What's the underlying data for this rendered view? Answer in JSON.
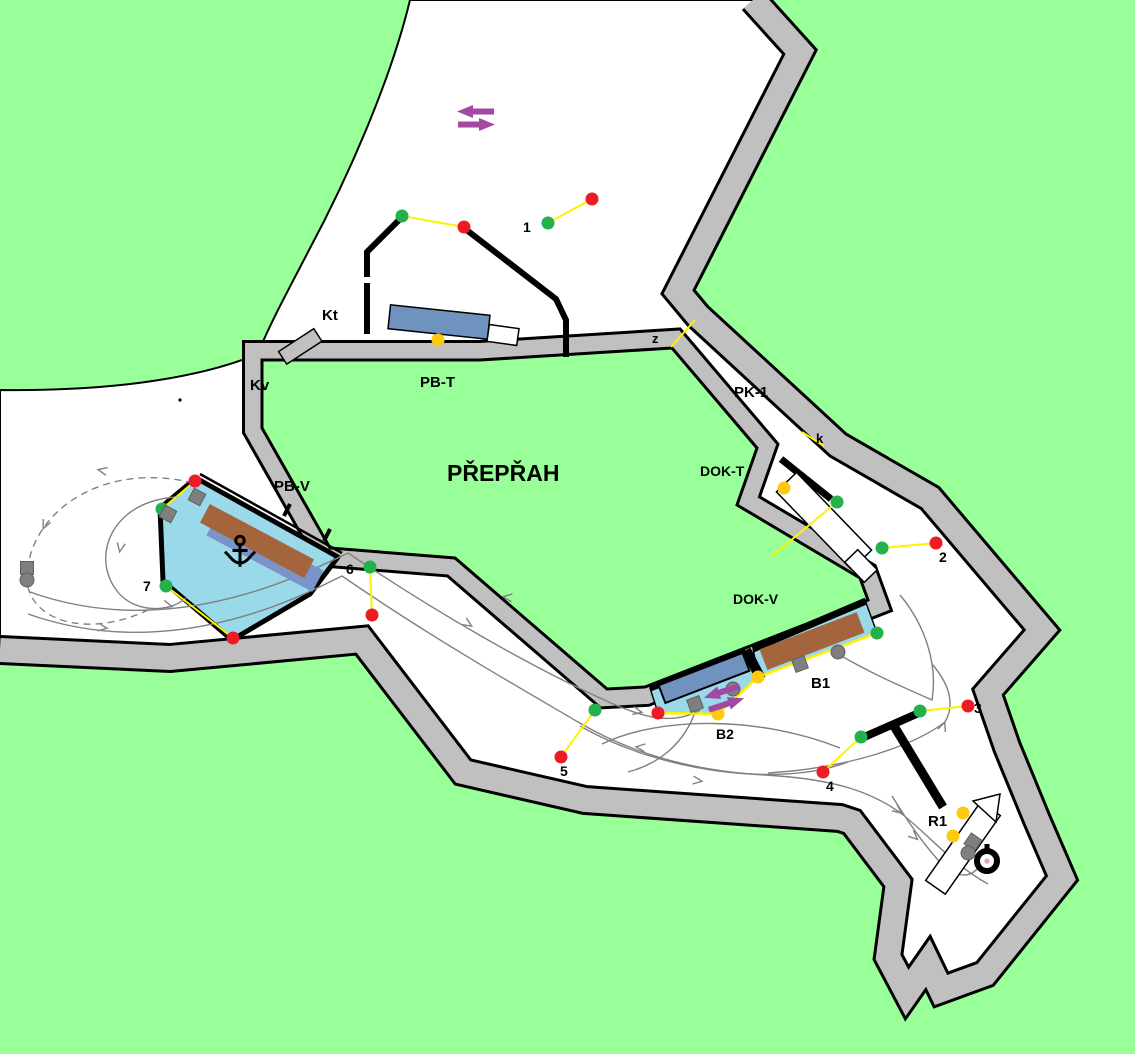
{
  "title": {
    "text": "PŘEPŘAH",
    "x": 447,
    "y": 481,
    "size": 23
  },
  "colors": {
    "land": "#99FF99",
    "water": "#FFFFFF",
    "embankment": "#C0C0C0",
    "outline": "#000000",
    "basin": "#99D9EA",
    "basin_shadow": "#7B93C7",
    "barge_blue": "#7092BE",
    "barge_brown": "#A5653C",
    "dot_red": "#ED1C24",
    "dot_green": "#22B14C",
    "dot_gold": "#FFC90E",
    "line_yellow": "#FFF200",
    "arrow_purple": "#A349A4",
    "marker_gray": "#7F7F7F",
    "route_gray": "#808080"
  },
  "labels": [
    {
      "id": "kt",
      "text": "Kt",
      "x": 322,
      "y": 320,
      "size": 15
    },
    {
      "id": "kv",
      "text": "Kv",
      "x": 250,
      "y": 390,
      "size": 15
    },
    {
      "id": "pb-t",
      "text": "PB-T",
      "x": 420,
      "y": 387,
      "size": 15
    },
    {
      "id": "pb-v",
      "text": "PB-V",
      "x": 274,
      "y": 491,
      "size": 15
    },
    {
      "id": "pk-1",
      "text": "PK-1",
      "x": 734,
      "y": 397,
      "size": 15
    },
    {
      "id": "dok-t",
      "text": "DOK-T",
      "x": 700,
      "y": 476,
      "size": 14
    },
    {
      "id": "dok-v",
      "text": "DOK-V",
      "x": 733,
      "y": 604,
      "size": 14
    },
    {
      "id": "b1",
      "text": "B1",
      "x": 811,
      "y": 688,
      "size": 15
    },
    {
      "id": "b2",
      "text": "B2",
      "x": 716,
      "y": 739,
      "size": 14
    },
    {
      "id": "r1",
      "text": "R1",
      "x": 928,
      "y": 826,
      "size": 15
    },
    {
      "id": "n1",
      "text": "1",
      "x": 523,
      "y": 232,
      "size": 14
    },
    {
      "id": "n2",
      "text": "2",
      "x": 939,
      "y": 562,
      "size": 14
    },
    {
      "id": "n3",
      "text": "3",
      "x": 974,
      "y": 713,
      "size": 14
    },
    {
      "id": "n4",
      "text": "4",
      "x": 826,
      "y": 791,
      "size": 14
    },
    {
      "id": "n5",
      "text": "5",
      "x": 560,
      "y": 776,
      "size": 14
    },
    {
      "id": "n6",
      "text": "6",
      "x": 346,
      "y": 574,
      "size": 14
    },
    {
      "id": "n7",
      "text": "7",
      "x": 143,
      "y": 591,
      "size": 14
    },
    {
      "id": "z",
      "text": "z",
      "x": 652,
      "y": 343,
      "size": 13
    },
    {
      "id": "k",
      "text": "k",
      "x": 816,
      "y": 443,
      "size": 13
    }
  ],
  "nav_points": [
    {
      "c": "green",
      "x": 402,
      "y": 216
    },
    {
      "c": "green",
      "x": 548,
      "y": 223
    },
    {
      "c": "green",
      "x": 162,
      "y": 509
    },
    {
      "c": "green",
      "x": 166,
      "y": 586
    },
    {
      "c": "green",
      "x": 370,
      "y": 567
    },
    {
      "c": "green",
      "x": 595,
      "y": 710
    },
    {
      "c": "green",
      "x": 837,
      "y": 502
    },
    {
      "c": "green",
      "x": 882,
      "y": 548
    },
    {
      "c": "green",
      "x": 877,
      "y": 633
    },
    {
      "c": "green",
      "x": 920,
      "y": 711
    },
    {
      "c": "green",
      "x": 861,
      "y": 737
    },
    {
      "c": "red",
      "x": 464,
      "y": 227
    },
    {
      "c": "red",
      "x": 592,
      "y": 199
    },
    {
      "c": "red",
      "x": 195,
      "y": 481
    },
    {
      "c": "red",
      "x": 233,
      "y": 638
    },
    {
      "c": "red",
      "x": 372,
      "y": 615
    },
    {
      "c": "red",
      "x": 561,
      "y": 757
    },
    {
      "c": "red",
      "x": 658,
      "y": 713
    },
    {
      "c": "red",
      "x": 936,
      "y": 543
    },
    {
      "c": "red",
      "x": 968,
      "y": 706
    },
    {
      "c": "red",
      "x": 823,
      "y": 772
    },
    {
      "c": "gold",
      "x": 438,
      "y": 340
    },
    {
      "c": "gold",
      "x": 784,
      "y": 488
    },
    {
      "c": "gold",
      "x": 758,
      "y": 677
    },
    {
      "c": "gold",
      "x": 718,
      "y": 714
    },
    {
      "c": "gold",
      "x": 963,
      "y": 813
    },
    {
      "c": "gold",
      "x": 953,
      "y": 836
    }
  ],
  "yellow_segments": [
    [
      402,
      216,
      464,
      227
    ],
    [
      548,
      223,
      592,
      199
    ],
    [
      162,
      509,
      195,
      481
    ],
    [
      166,
      586,
      233,
      638
    ],
    [
      370,
      567,
      372,
      615
    ],
    [
      595,
      710,
      561,
      757
    ],
    [
      882,
      548,
      936,
      543
    ],
    [
      837,
      502,
      772,
      556
    ],
    [
      920,
      711,
      968,
      706
    ],
    [
      861,
      737,
      823,
      772
    ],
    [
      877,
      633,
      758,
      677
    ],
    [
      758,
      677,
      718,
      714
    ],
    [
      718,
      714,
      658,
      713
    ],
    [
      671,
      347,
      695,
      320
    ],
    [
      802,
      432,
      824,
      446
    ]
  ],
  "gray_markers": {
    "squares": [
      {
        "x": 197,
        "y": 497,
        "rot": 28
      },
      {
        "x": 168,
        "y": 514,
        "rot": 28
      },
      {
        "x": 27,
        "y": 568,
        "rot": 0
      },
      {
        "x": 695,
        "y": 704,
        "rot": -20
      },
      {
        "x": 800,
        "y": 664,
        "rot": -20
      },
      {
        "x": 973,
        "y": 842,
        "rot": -55
      }
    ],
    "circles": [
      {
        "x": 27,
        "y": 580
      },
      {
        "x": 733,
        "y": 689
      },
      {
        "x": 838,
        "y": 652
      },
      {
        "x": 968,
        "y": 853
      }
    ]
  },
  "walls": [
    {
      "name": "training-wall-left-upper",
      "pts": [
        [
          402,
          217
        ],
        [
          367,
          252
        ],
        [
          367,
          277
        ]
      ],
      "w": 6
    },
    {
      "name": "training-wall-left-lower",
      "pts": [
        [
          367,
          283
        ],
        [
          367,
          334
        ]
      ],
      "w": 6
    },
    {
      "name": "training-wall-right",
      "pts": [
        [
          464,
          228
        ],
        [
          556,
          299
        ],
        [
          566,
          320
        ],
        [
          566,
          357
        ]
      ],
      "w": 6
    },
    {
      "name": "dokt-quay-wall",
      "pts": [
        [
          781,
          459
        ],
        [
          831,
          499
        ]
      ],
      "w": 7
    },
    {
      "name": "r1-t-wall-horizontal",
      "pts": [
        [
          862,
          738
        ],
        [
          921,
          712
        ]
      ],
      "w": 8
    },
    {
      "name": "r1-t-wall-vertical",
      "pts": [
        [
          894,
          726
        ],
        [
          943,
          807
        ]
      ],
      "w": 9
    },
    {
      "name": "b2-quay-wall",
      "pts": [
        [
          650,
          688
        ],
        [
          746,
          652
        ]
      ],
      "w": 7
    },
    {
      "name": "b1-quay-wall",
      "pts": [
        [
          753,
          649
        ],
        [
          866,
          601
        ]
      ],
      "w": 7
    },
    {
      "name": "b1-b2-separator-wall",
      "pts": [
        [
          746,
          650
        ],
        [
          761,
          679
        ]
      ],
      "w": 10
    },
    {
      "name": "pbv-dolphin-1",
      "pts": [
        [
          290,
          504
        ],
        [
          284,
          516
        ]
      ],
      "w": 4
    },
    {
      "name": "pbv-dolphin-2",
      "pts": [
        [
          330,
          529
        ],
        [
          324,
          541
        ]
      ],
      "w": 4
    }
  ],
  "vessels": [
    {
      "name": "pbv-barge-shadow",
      "shape": "rect",
      "cx": 265,
      "cy": 553,
      "w": 120,
      "h": 24,
      "rot": 28,
      "fill": "basin_shadow",
      "stroke": "none",
      "sw": 0
    },
    {
      "name": "pbv-barge",
      "shape": "rect",
      "cx": 257,
      "cy": 541,
      "w": 118,
      "h": 21,
      "rot": 28,
      "fill": "barge_brown",
      "stroke": "none",
      "sw": 0
    },
    {
      "name": "pbt-barge",
      "shape": "rect",
      "cx": 439,
      "cy": 322,
      "w": 100,
      "h": 24,
      "rot": 6,
      "fill": "barge_blue",
      "stroke": "outline",
      "sw": 1.5
    },
    {
      "name": "pbt-pusher",
      "shape": "rect",
      "cx": 503,
      "cy": 335,
      "w": 30,
      "h": 17,
      "rot": 8,
      "fill": "water",
      "stroke": "outline",
      "sw": 1.5
    },
    {
      "name": "dokt-vessel",
      "shape": "rect",
      "cx": 824,
      "cy": 521,
      "w": 108,
      "h": 28,
      "rot": 46,
      "fill": "water",
      "stroke": "outline",
      "sw": 1.5
    },
    {
      "name": "dokt-pusher",
      "shape": "rect",
      "cx": 861,
      "cy": 566,
      "w": 28,
      "h": 18,
      "rot": 46,
      "fill": "water",
      "stroke": "outline",
      "sw": 1.5
    },
    {
      "name": "b2-barge",
      "shape": "rect",
      "cx": 704,
      "cy": 678,
      "w": 90,
      "h": 19,
      "rot": -21,
      "fill": "barge_blue",
      "stroke": "outline",
      "sw": 2
    },
    {
      "name": "b1-barge",
      "shape": "rect",
      "cx": 812,
      "cy": 641,
      "w": 104,
      "h": 22,
      "rot": -21,
      "fill": "barge_brown",
      "stroke": "none",
      "sw": 0
    },
    {
      "name": "r1-vessel",
      "shape": "rect",
      "cx": 963,
      "cy": 848,
      "w": 96,
      "h": 24,
      "rot": -55,
      "fill": "water",
      "stroke": "outline",
      "sw": 1.5
    },
    {
      "name": "r1-vessel-bow",
      "shape": "polygon",
      "pts": [
        [
          973,
          801
        ],
        [
          1000,
          794
        ],
        [
          996,
          822
        ]
      ],
      "fill": "water",
      "stroke": "outline",
      "sw": 1.5
    }
  ],
  "current_arrows": [
    {
      "cx": 476,
      "cy": 118,
      "rot": 0
    },
    {
      "cx": 724,
      "cy": 698,
      "rot": -18
    }
  ],
  "symbols": {
    "anchor": {
      "x": 240,
      "y": 553
    },
    "mooring_buoy": {
      "x": 987,
      "y": 861
    },
    "small_dot": {
      "x": 180,
      "y": 400
    }
  }
}
